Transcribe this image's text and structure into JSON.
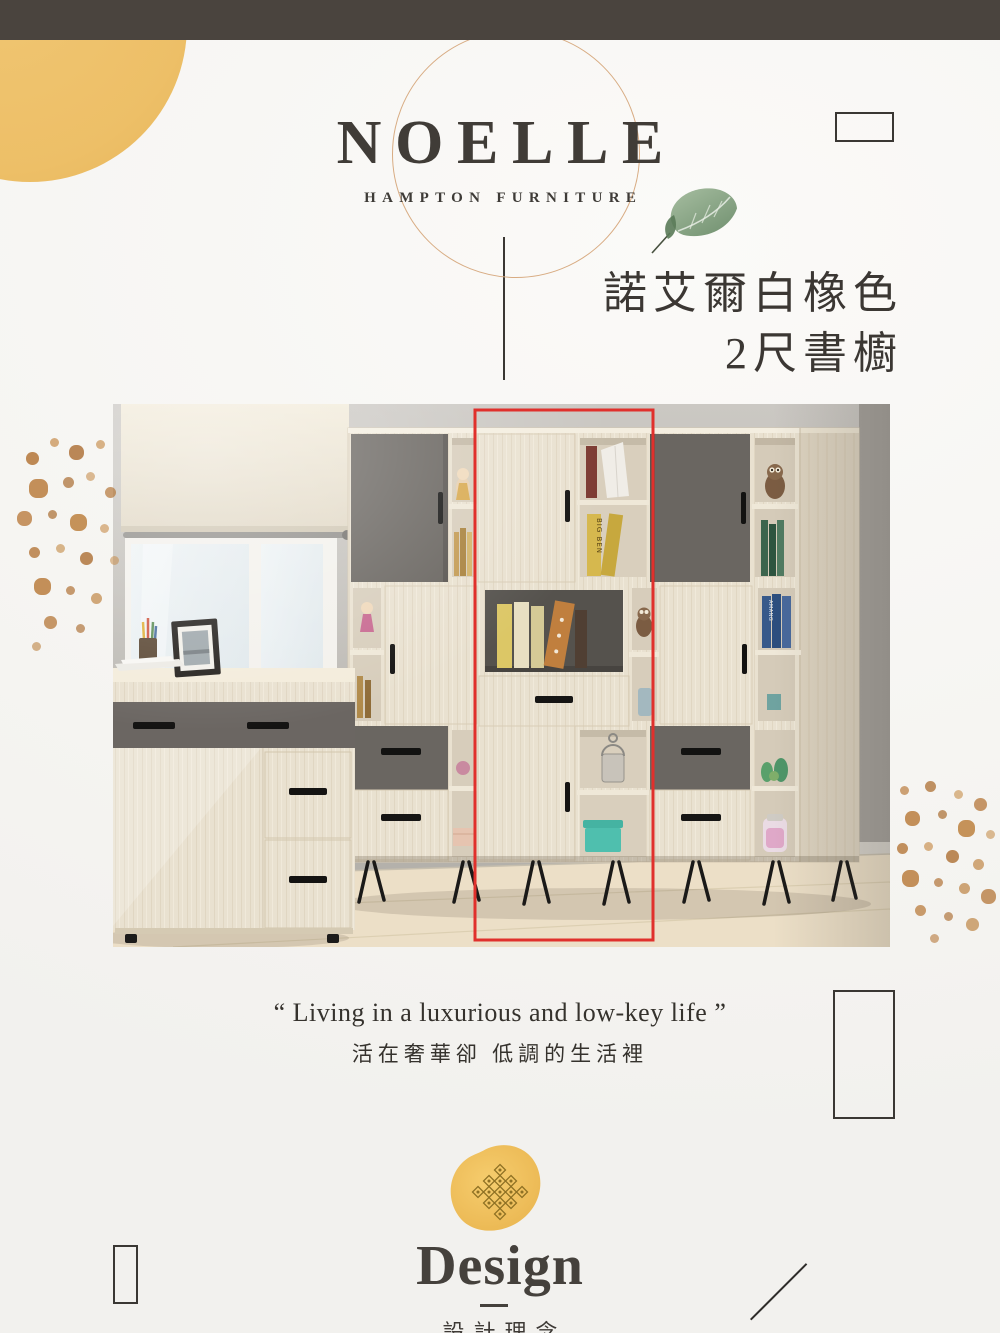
{
  "theme": {
    "topbar_color": "#4a443e",
    "paper_color": "#f6f5f2",
    "accent_yellow": "#edbf67",
    "splatter_color": "#b9803f",
    "outline_circle_color": "#d8ac83",
    "highlight_red": "#e0302c",
    "text_dark": "#3e3a35"
  },
  "brand": {
    "name": "NOELLE",
    "subtitle": "HAMPTON FURNITURE"
  },
  "product": {
    "title_line1": "諾艾爾白橡色",
    "title_line2": "2尺書櫥"
  },
  "photo": {
    "spines": {
      "big_ben": "BIG BEN",
      "amang": "AMANG"
    }
  },
  "quote": {
    "english": "“ Living in a luxurious and low-key life ”",
    "chinese": "活在奢華卻 低調的生活裡"
  },
  "design_section": {
    "heading": "Design",
    "subheading": "設計理念"
  }
}
